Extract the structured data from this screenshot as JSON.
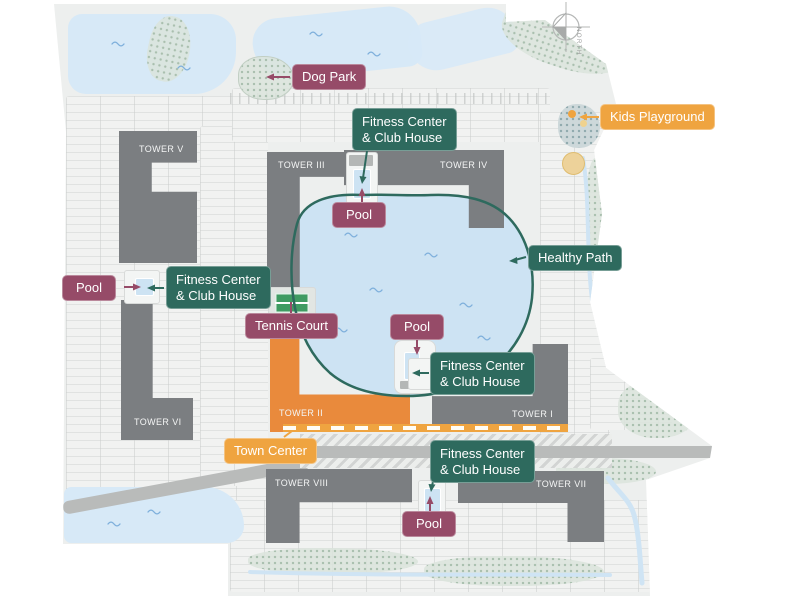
{
  "compass": {
    "label": "NORTH"
  },
  "towers": [
    {
      "label": "TOWER V"
    },
    {
      "label": "TOWER VI"
    },
    {
      "label": "TOWER III"
    },
    {
      "label": "TOWER IV"
    },
    {
      "label": "TOWER II"
    },
    {
      "label": "TOWER I"
    },
    {
      "label": "TOWER VIII"
    },
    {
      "label": "TOWER VII"
    }
  ],
  "badges": {
    "dog_park": "Dog Park",
    "kids_playground": "Kids Playground",
    "healthy_path": "Healthy Path",
    "tennis_court": "Tennis Court",
    "town_center": "Town Center",
    "fitness_centers": [
      {
        "line1": "Fitness Center",
        "line2": "& Club House"
      },
      {
        "line1": "Fitness Center",
        "line2": "& Club House"
      },
      {
        "line1": "Fitness Center",
        "line2": "& Club House"
      },
      {
        "line1": "Fitness Center",
        "line2": "& Club House"
      }
    ],
    "pools": [
      "Pool",
      "Pool",
      "Pool",
      "Pool"
    ]
  },
  "colors": {
    "badge_purple": "#964B68",
    "badge_teal": "#2E6A5E",
    "badge_orange": "#EFA440",
    "tower_gray": "#7B7E81",
    "tower_orange": "#E98A3C",
    "water": "#CDE3F3",
    "pond": "#D7E9F7",
    "path_green": "#2E6A5E",
    "road": "#B9BBBA",
    "map_bg": "#EDEFEE",
    "sage": "#CBD9CE"
  }
}
